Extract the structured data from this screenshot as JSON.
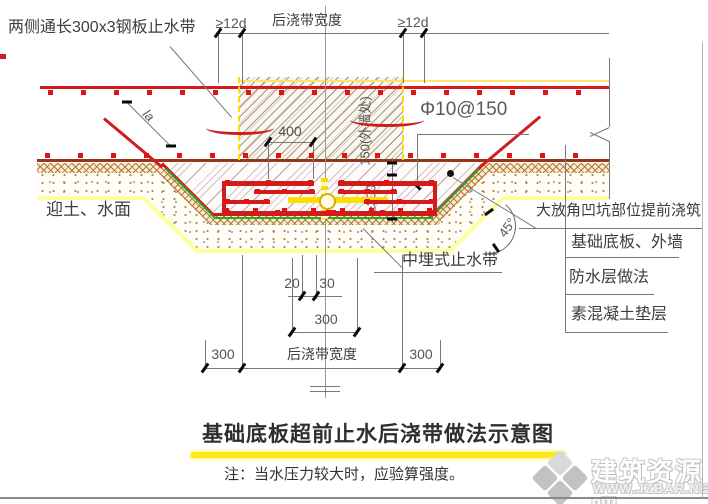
{
  "drawing": {
    "callouts": {
      "steel_plate": "两侧通长300x3钢板止水带",
      "rebar_spec": "Φ10@150",
      "soil_water_side": "迎土、水面",
      "mid_embedded_waterstop": "中埋式止水带",
      "pit_precast": "大放角凹坑部位提前浇筑",
      "base_slab_wall": "基础底板、外墙",
      "waterproof_layer": "防水层做法",
      "plain_concrete_cushion": "素混凝土垫层",
      "slope_angle": "45°",
      "anchor_length": "la"
    },
    "dimensions": {
      "band_width_top": "后浇带宽度",
      "ge_12d_left": "≥12d",
      "ge_12d_right": "≥12d",
      "d400": "400",
      "depth_at_wall": "150(外墙处)",
      "depth_min": "≥300",
      "d20": "20",
      "d30": "30",
      "d300_center": "300",
      "d300_left": "300",
      "band_width_bottom": "后浇带宽度",
      "d300_right": "300"
    },
    "title": "基础底板超前止水后浇带做法示意图",
    "note": "注：当水压力较大时，应验算强度。"
  },
  "watermark": {
    "site_name": "建筑资源吧",
    "site_url": "WWW.JZBAR.NET"
  },
  "colors": {
    "rebar_red": "#d11c1c",
    "slab_soffit_brown": "#93361a",
    "waterproofing_green": "#28a828",
    "waterstop_yellow": "#ffdf00",
    "title_highlight_yellow": "#ffe81a",
    "new_concrete_hatch_pink": "#e070c8"
  }
}
